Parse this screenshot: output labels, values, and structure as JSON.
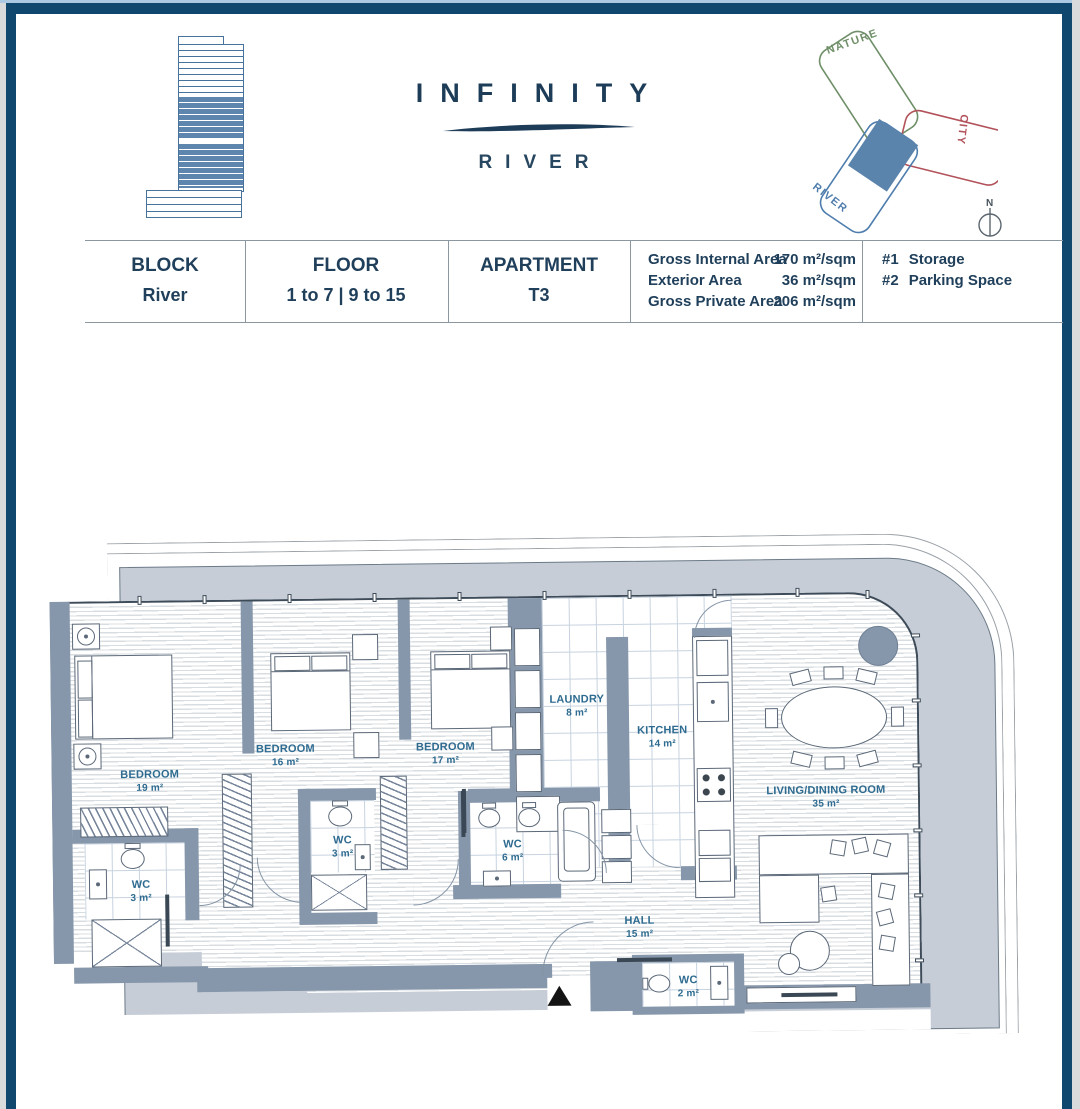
{
  "header": {
    "brand_title": "INFINITY",
    "brand_subtitle": "RIVER",
    "site_diagram": {
      "nature": "NATURE",
      "city": "CITY",
      "river": "RIVER"
    },
    "compass": "N"
  },
  "info_table": {
    "cells": [
      {
        "label": "BLOCK",
        "value": "River"
      },
      {
        "label": "FLOOR",
        "value": "1 to 7 | 9 to 15"
      },
      {
        "label": "APARTMENT",
        "value": "T3"
      }
    ],
    "areas": [
      {
        "name": "Gross Internal Area",
        "value": "170 m²/sqm"
      },
      {
        "name": "Exterior Area",
        "value": "36 m²/sqm"
      },
      {
        "name": "Gross Private Area",
        "value": "206 m²/sqm"
      }
    ],
    "extras": [
      {
        "num": "#1",
        "label": "Storage"
      },
      {
        "num": "#2",
        "label": "Parking Space"
      }
    ]
  },
  "floor_plan": {
    "rooms": [
      {
        "name": "BEDROOM",
        "area": "19 m²"
      },
      {
        "name": "BEDROOM",
        "area": "16 m²"
      },
      {
        "name": "BEDROOM",
        "area": "17 m²"
      },
      {
        "name": "LAUNDRY",
        "area": "8 m²"
      },
      {
        "name": "KITCHEN",
        "area": "14 m²"
      },
      {
        "name": "LIVING/DINING ROOM",
        "area": "35 m²"
      },
      {
        "name": "WC",
        "area": "3 m²"
      },
      {
        "name": "WC",
        "area": "3 m²"
      },
      {
        "name": "WC",
        "area": "6 m²"
      },
      {
        "name": "HALL",
        "area": "15 m²"
      },
      {
        "name": "WC",
        "area": "2 m²"
      }
    ]
  },
  "colors": {
    "frame_navy": "#10476e",
    "brand_navy": "#1d3c58",
    "wall_slate": "#8697ab",
    "terrace_gray": "#c6cdd6",
    "room_label_blue": "#2e6b90",
    "logo_blue": "#5e85ae",
    "nature_green": "#6f8f68",
    "city_red": "#b2525a",
    "river_blue": "#4e7dad"
  }
}
